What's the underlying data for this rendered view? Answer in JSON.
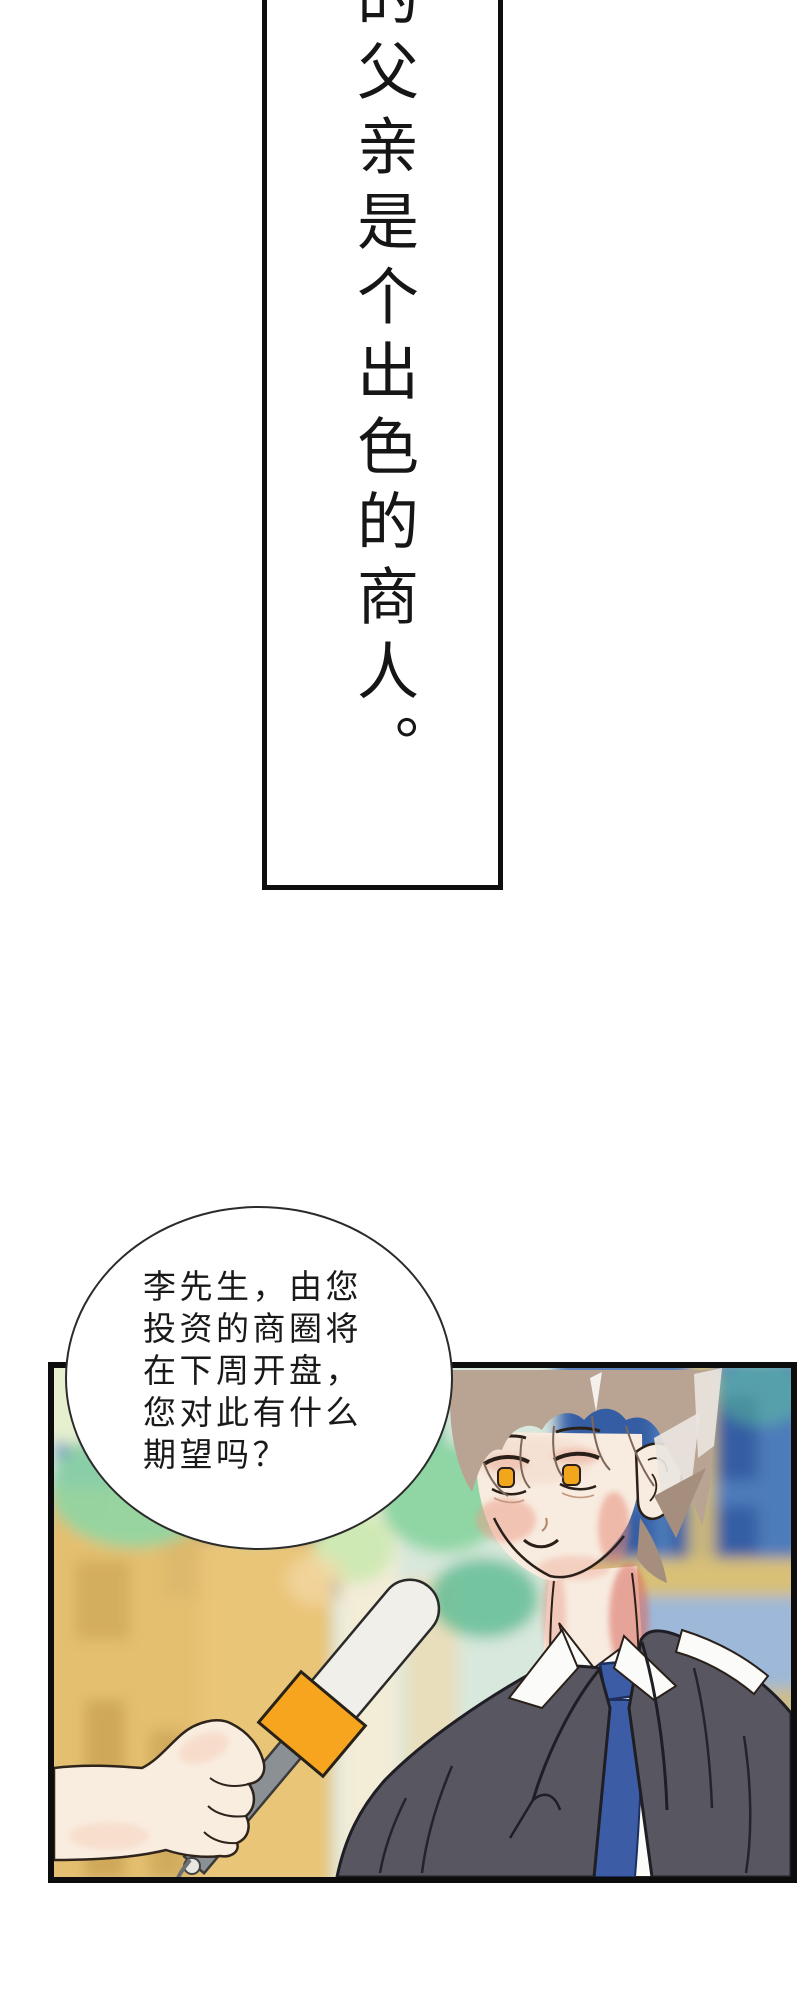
{
  "narration_panel": {
    "text": "的父亲是个出色的商人。",
    "text_color": "#161616",
    "border_color": "#0e0e0e",
    "fill": "#ffffff"
  },
  "speech_bubble": {
    "lines": [
      "李先生，由您",
      "投资的商圈将",
      "在下周开盘，",
      "您对此有什么",
      "期望吗？"
    ],
    "text_color": "#191919",
    "outline_color": "#2b2b2b",
    "fill": "#ffffff"
  },
  "scene": {
    "border_color": "#0d0d0d",
    "palette": {
      "base_wash": "#d8e8dc",
      "foliage_pale": "#e6f0cf",
      "foliage_light": "#cfe9b4",
      "foliage_green": "#8fd6a4",
      "foliage_teal": "#5fc49b",
      "foliage_deep": "#63bd95",
      "window_blue": "#4d7cba",
      "window_pane": "#30589f",
      "window_pale": "#9db8d8",
      "window_lower": "#7d9cc4",
      "band_tan": "#d8c077",
      "band_tan_light": "#cdbd8a",
      "building_ochre": "#e5bd68",
      "building_ochre2": "#e9c578",
      "building_shadow": "#c9a355",
      "column_cream": "#f3ecd7",
      "column_pale": "#ecdcb6",
      "hair": "#b9a393",
      "hair_dark": "#a68e7e",
      "hair_highlight": "#eae5e0",
      "skin": "#f8ebdf",
      "blush": "#ec9d89",
      "blush_deep": "#e58874",
      "neck_red": "#d96a5e",
      "iris_amber": "#f2a61c",
      "shirt": "#fbfbf9",
      "tie": "#3c5da5",
      "suit": "#585761",
      "mic_head": "#f1efe9",
      "mic_band": "#f7a51f",
      "mic_grip": "#8b9094",
      "hand_skin": "#f9ede0"
    }
  }
}
